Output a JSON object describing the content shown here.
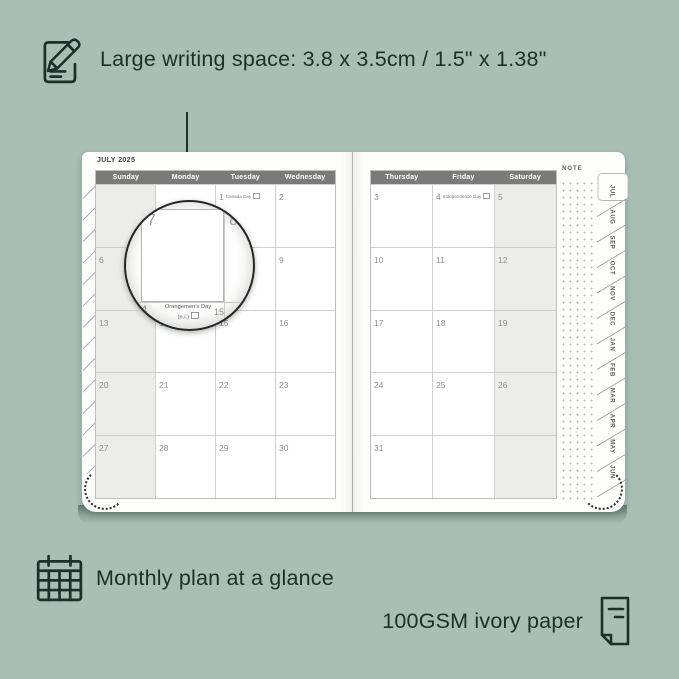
{
  "colors": {
    "background": "#a9beb4",
    "ink": "#1d2e2b",
    "page": "#fdfdfb",
    "header_gray": "#7a7a7a",
    "shaded_cell": "#ececea",
    "grid_line": "#cfcfcc"
  },
  "features": {
    "writing_space": {
      "label": "Large writing space: 3.8 x 3.5cm / 1.5\" x 1.38\"",
      "icon": "notepad-pencil-icon"
    },
    "monthly_plan": {
      "label": "Monthly plan at a glance",
      "icon": "calendar-grid-icon"
    },
    "paper": {
      "label": "100GSM ivory paper",
      "icon": "paper-sheet-icon"
    }
  },
  "planner": {
    "month_title": "JULY 2025",
    "note_label": "NOTE",
    "left_page": {
      "weekdays": [
        "Sunday",
        "Monday",
        "Tuesday",
        "Wednesday"
      ],
      "shaded_column": 0,
      "rows": [
        [
          {
            "date": ""
          },
          {
            "date": ""
          },
          {
            "date": "1",
            "holiday": "Canada Day"
          },
          {
            "date": "2"
          }
        ],
        [
          {
            "date": "6"
          },
          {
            "date": "7"
          },
          {
            "date": "8"
          },
          {
            "date": "9"
          }
        ],
        [
          {
            "date": "13"
          },
          {
            "date": "14",
            "holiday": "Orangemen's Day (n.i.)"
          },
          {
            "date": "15"
          },
          {
            "date": "16"
          }
        ],
        [
          {
            "date": "20"
          },
          {
            "date": "21"
          },
          {
            "date": "22"
          },
          {
            "date": "23"
          }
        ],
        [
          {
            "date": "27"
          },
          {
            "date": "28"
          },
          {
            "date": "29"
          },
          {
            "date": "30"
          }
        ]
      ]
    },
    "right_page": {
      "weekdays": [
        "Thursday",
        "Friday",
        "Saturday"
      ],
      "shaded_column": 2,
      "rows": [
        [
          {
            "date": "3"
          },
          {
            "date": "4",
            "holiday": "Independence Day"
          },
          {
            "date": "5"
          }
        ],
        [
          {
            "date": "10"
          },
          {
            "date": "11"
          },
          {
            "date": "12"
          }
        ],
        [
          {
            "date": "17"
          },
          {
            "date": "18"
          },
          {
            "date": "19"
          }
        ],
        [
          {
            "date": "24"
          },
          {
            "date": "25"
          },
          {
            "date": "26"
          }
        ],
        [
          {
            "date": "31"
          },
          {
            "date": ""
          },
          {
            "date": ""
          }
        ]
      ]
    },
    "tabs": {
      "months": [
        "JUL",
        "AUG",
        "SEP",
        "OCT",
        "NOV",
        "DEC",
        "JAN",
        "FEB",
        "MAR",
        "APR",
        "MAY",
        "JUN"
      ],
      "active": "JUL"
    }
  },
  "magnifier": {
    "left_day": "7",
    "right_day": "8",
    "bottom_left_day": "14",
    "bottom_right_day": "15",
    "holiday_line1": "Orangemen's Day",
    "holiday_line2": "(n.i.)"
  }
}
